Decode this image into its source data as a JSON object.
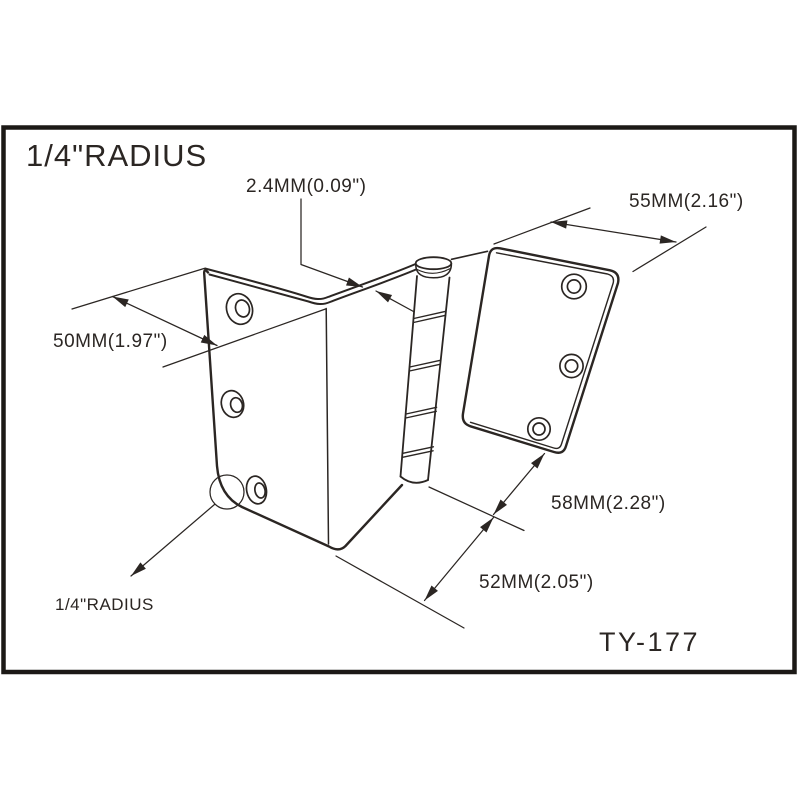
{
  "labels": {
    "radius_top": "1/4\"RADIUS",
    "thickness": "2.4MM(0.09\")",
    "width_55": "55MM(2.16\")",
    "width_50": "50MM(1.97\")",
    "length_58": "58MM(2.28\")",
    "length_52": "52MM(2.05\")",
    "radius_bottom": "1/4\"RADIUS",
    "part_number": "TY-177"
  },
  "colors": {
    "line": "#2b2623",
    "border": "#1c1916",
    "background": "#ffffff"
  }
}
